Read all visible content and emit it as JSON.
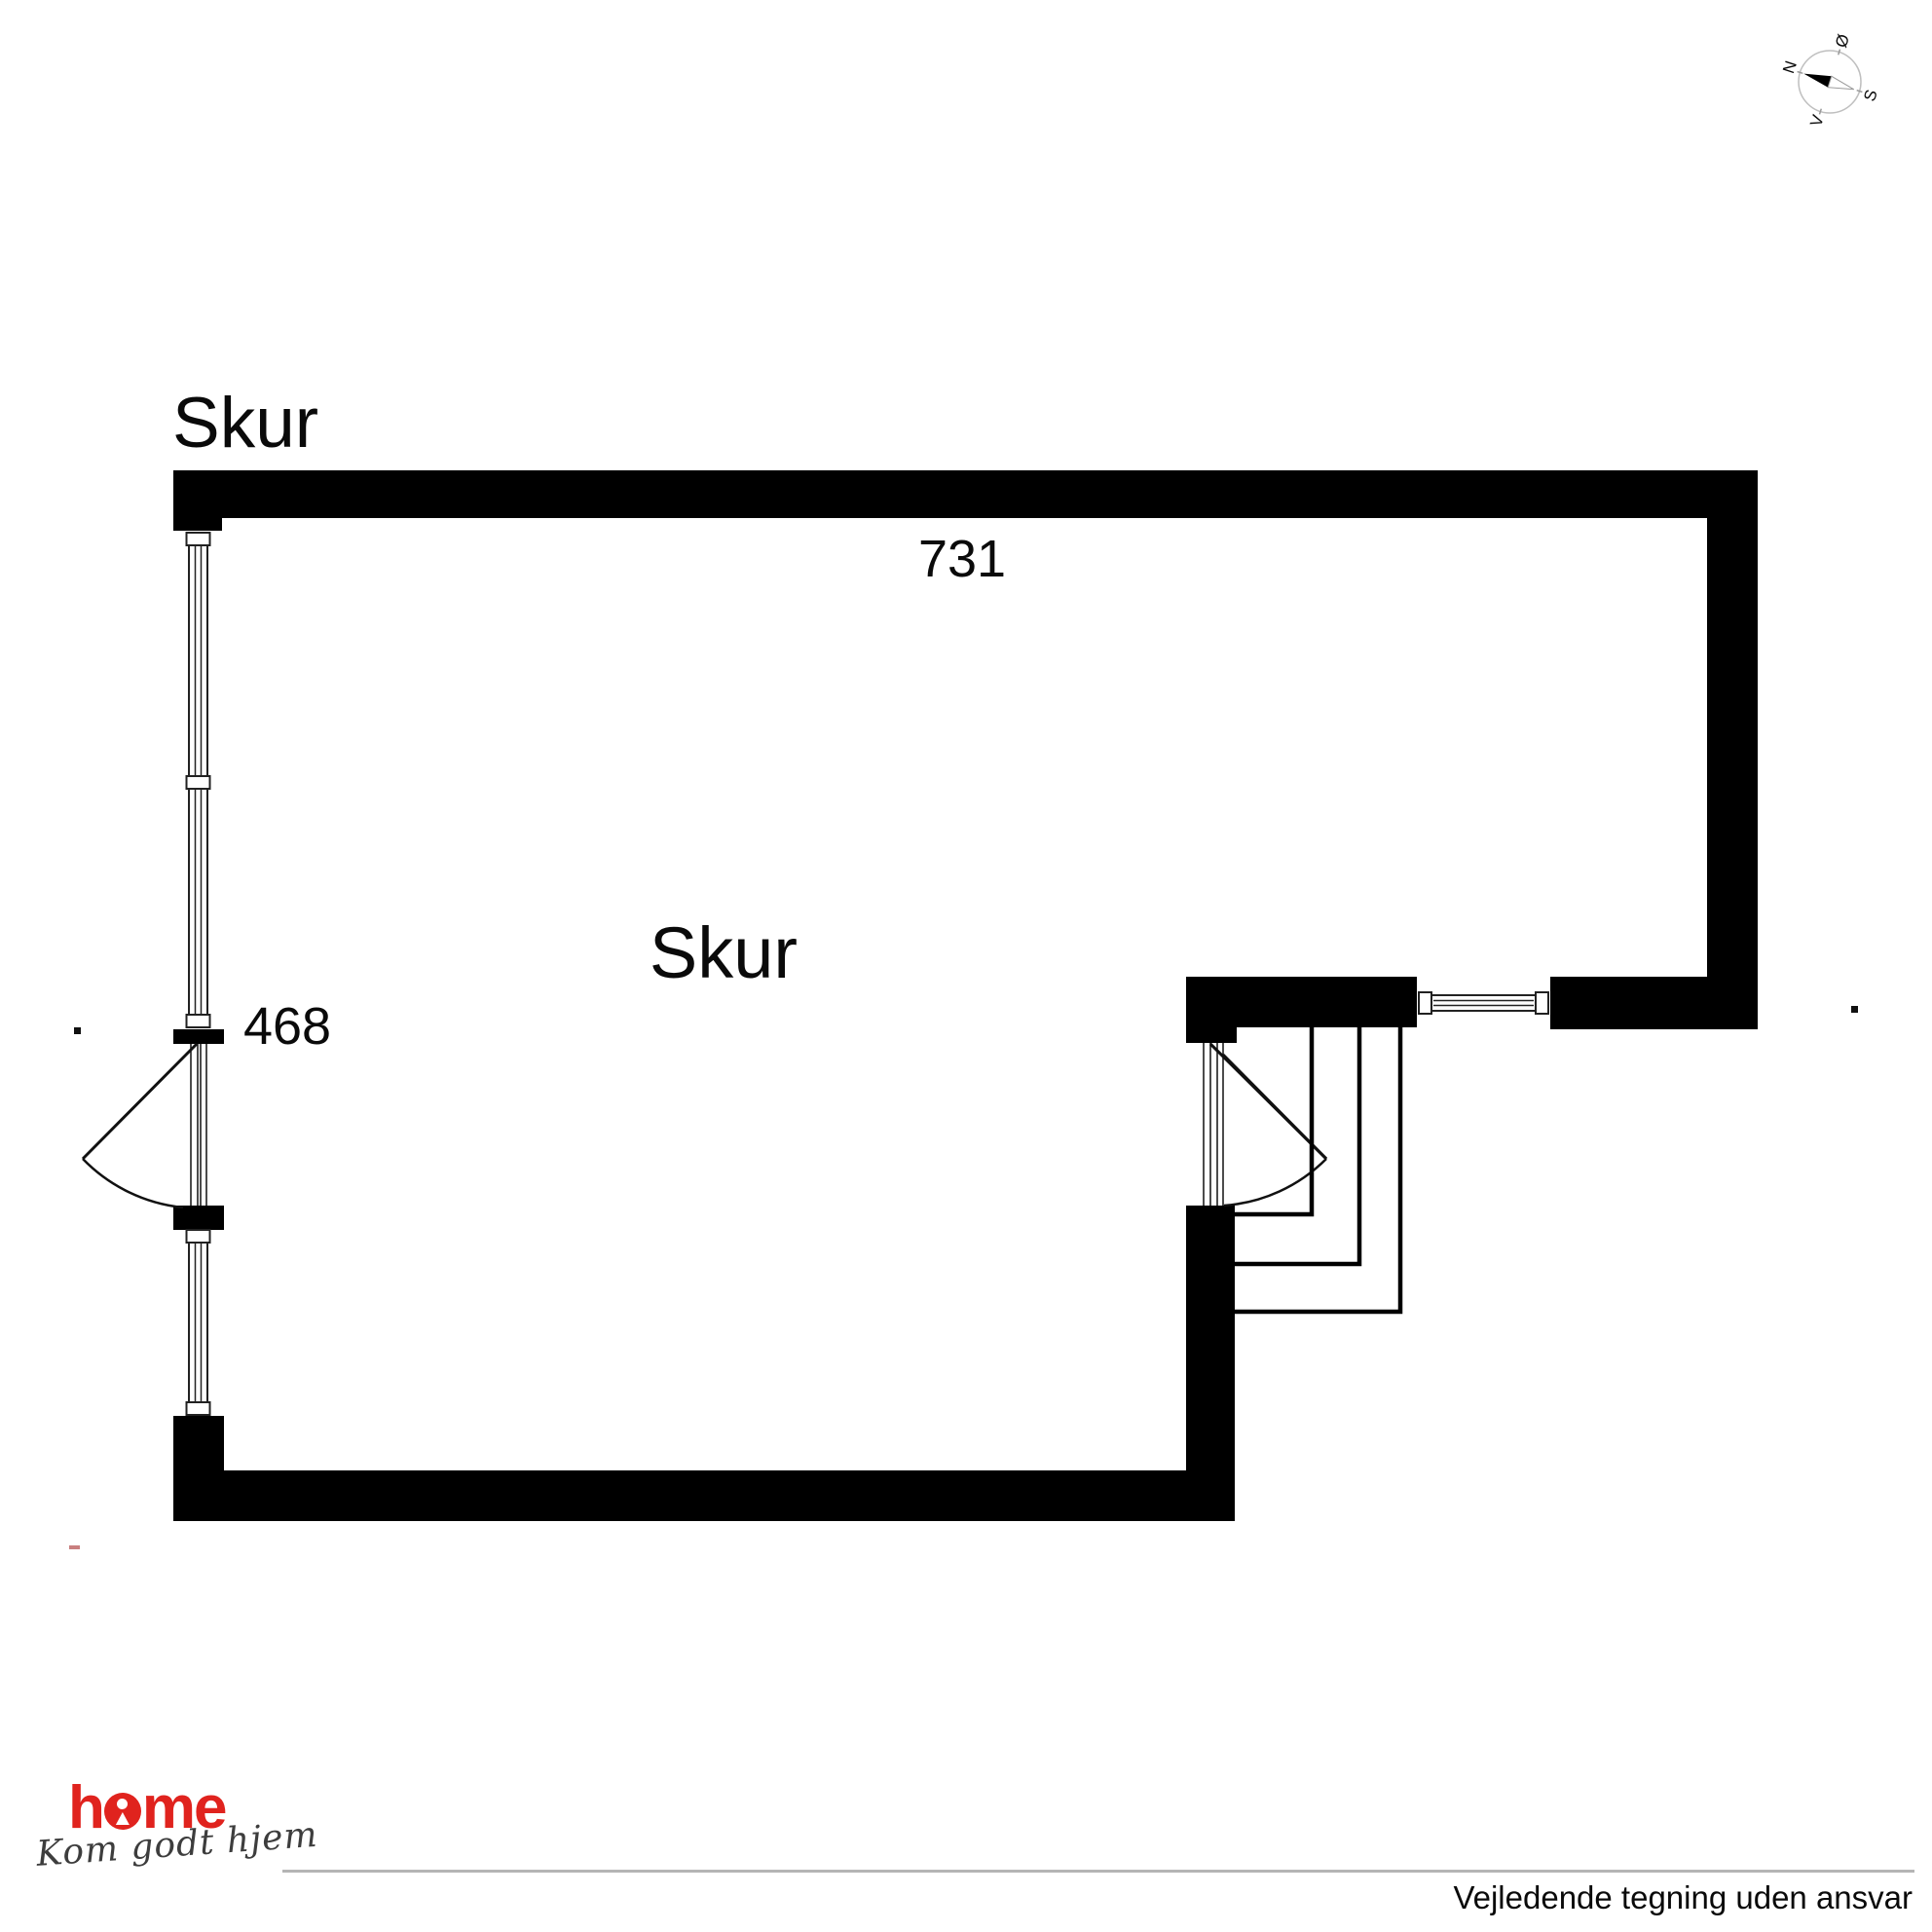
{
  "title": "Skur",
  "plan": {
    "room_label": "Skur",
    "dim_width": "731",
    "dim_height": "468"
  },
  "compass": {
    "n": "N",
    "e": "Ø",
    "s": "S",
    "v": "V"
  },
  "footer": {
    "brand_h": "h",
    "brand_me": "me",
    "tagline": "Kom godt hjem",
    "disclaimer": "Vejledende tegning uden ansvar",
    "brand_color": "#e0231e",
    "rule_color": "#b5b5b5"
  },
  "colors": {
    "wall": "#000000",
    "line": "#111111",
    "frame": "#222222"
  }
}
